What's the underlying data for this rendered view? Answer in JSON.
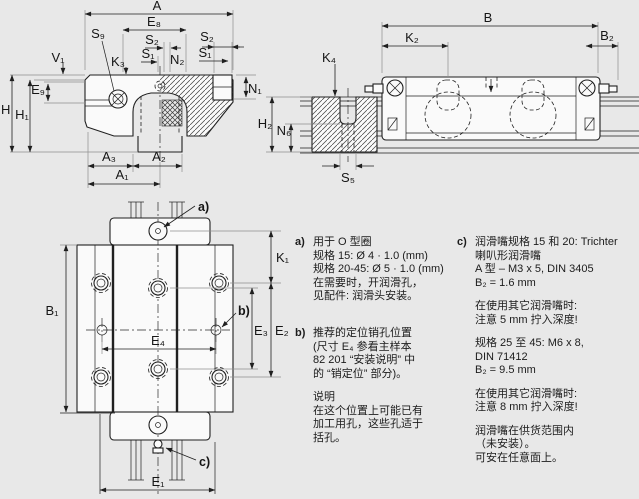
{
  "colors": {
    "background": "#e8e8e8",
    "line": "#1f1f1f",
    "drawing_fill": "#fafafa",
    "extension_line": "#8f8f8f",
    "text": "#1c1c1c"
  },
  "dims": {
    "cross_section": {
      "A": "A",
      "E8": "E₈",
      "S9": "S₉",
      "S2": "S₂",
      "S1": "S₁",
      "N2": "N₂",
      "K3": "K₃",
      "V1": "V₁",
      "E9": "E₉",
      "H": "H",
      "H1": "H₁",
      "N1": "N₁",
      "A3": "A₃",
      "A2": "A₂",
      "A1": "A₁"
    },
    "side_view": {
      "B": "B",
      "K2": "K₂",
      "B2": "B₂",
      "K4": "K₄",
      "H2": "H₂",
      "N6": "N₆",
      "S5": "S₅"
    },
    "top_view": {
      "B1": "B₁",
      "K1": "K₁",
      "E2": "E₂",
      "E3": "E₃",
      "E4": "E₄",
      "E1": "E₁"
    },
    "callouts": {
      "a": "a)",
      "b": "b)",
      "c": "c)"
    }
  },
  "notes": {
    "a": {
      "marker": "a)",
      "lines": [
        "用于 O 型圈",
        "规格 15: Ø 4 · 1.0 (mm)",
        "规格 20-45: Ø 5 · 1.0 (mm)",
        "在需要时，开润滑孔，",
        "见配件: 润滑头安装。"
      ]
    },
    "b": {
      "marker": "b)",
      "para1": [
        "推荐的定位销孔位置",
        "(尺寸 E₄ 参看主样本",
        "82 201 “安装说明” 中",
        "的 “销定位” 部分)。"
      ],
      "para2": [
        "说明",
        "在这个位置上可能已有",
        "加工用孔，这些孔适于",
        "括孔。"
      ]
    },
    "c": {
      "marker": "c)",
      "para1": [
        "润滑嘴规格 15 和 20: Trichter",
        "喇叭形润滑嘴",
        "A 型 – M3 x 5, DIN 3405",
        "B₂ = 1.6 mm"
      ],
      "para2": [
        "在使用其它润滑嘴时:",
        "注意 5 mm 拧入深度!"
      ],
      "para3": [
        "规格 25 至 45: M6 x 8,",
        "DIN 71412",
        "B₂ = 9.5 mm"
      ],
      "para4": [
        "在使用其它润滑嘴时:",
        "注意 8 mm 拧入深度!"
      ],
      "para5": [
        "润滑嘴在供货范围内",
        "（未安装）。",
        "可安在任意面上。"
      ]
    }
  }
}
